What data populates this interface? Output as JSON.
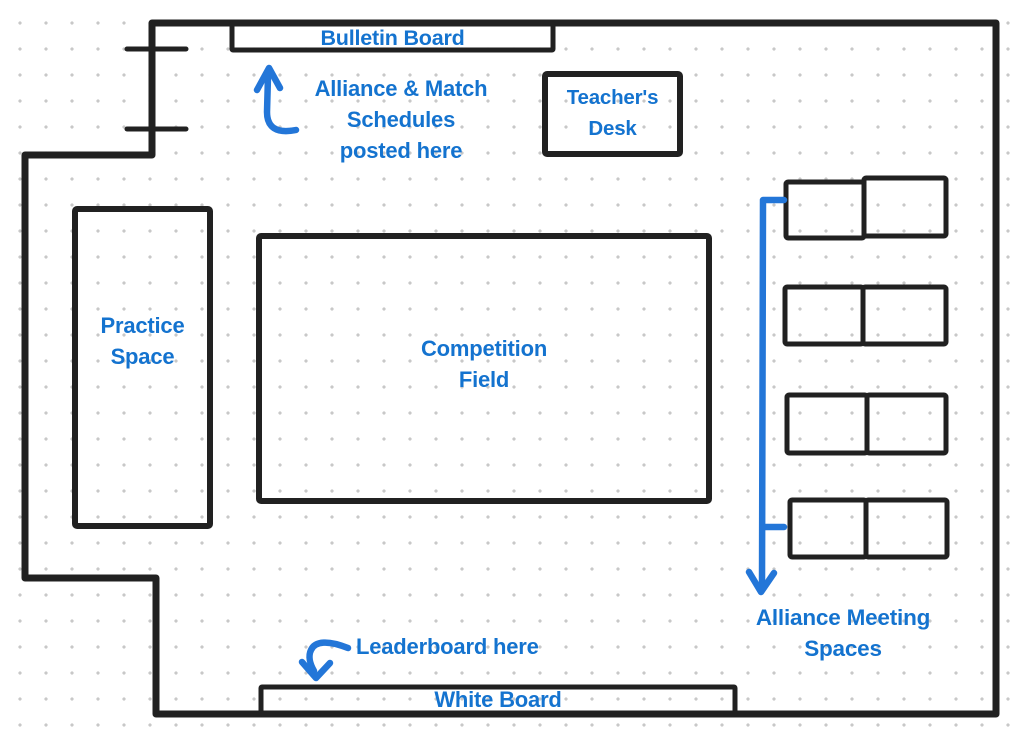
{
  "colors": {
    "ink": "#212121",
    "label_blue": "#1473cf",
    "arrow_blue": "#2376d8",
    "dot_grid": "#c8c8c8",
    "background": "#ffffff"
  },
  "labels": {
    "bulletin_board": "Bulletin Board",
    "schedules_note_line1": "Alliance & Match",
    "schedules_note_line2": "Schedules",
    "schedules_note_line3": "posted here",
    "teachers_desk_line1": "Teacher's",
    "teachers_desk_line2": "Desk",
    "practice_space_line1": "Practice",
    "practice_space_line2": "Space",
    "competition_field_line1": "Competition",
    "competition_field_line2": "Field",
    "alliance_meeting_line1": "Alliance Meeting",
    "alliance_meeting_line2": "Spaces",
    "leaderboard_note": "Leaderboard here",
    "white_board": "White Board"
  },
  "icons": {
    "up_arrow": "hand-drawn up arrow pointing at bulletin board",
    "down_arrow_long": "long hand-drawn down arrow spanning the alliance meeting tables",
    "down_arrow_curved": "curved hand-drawn down arrow pointing at white board",
    "door_ticks": "two short tick marks on upper-left wall segment"
  }
}
